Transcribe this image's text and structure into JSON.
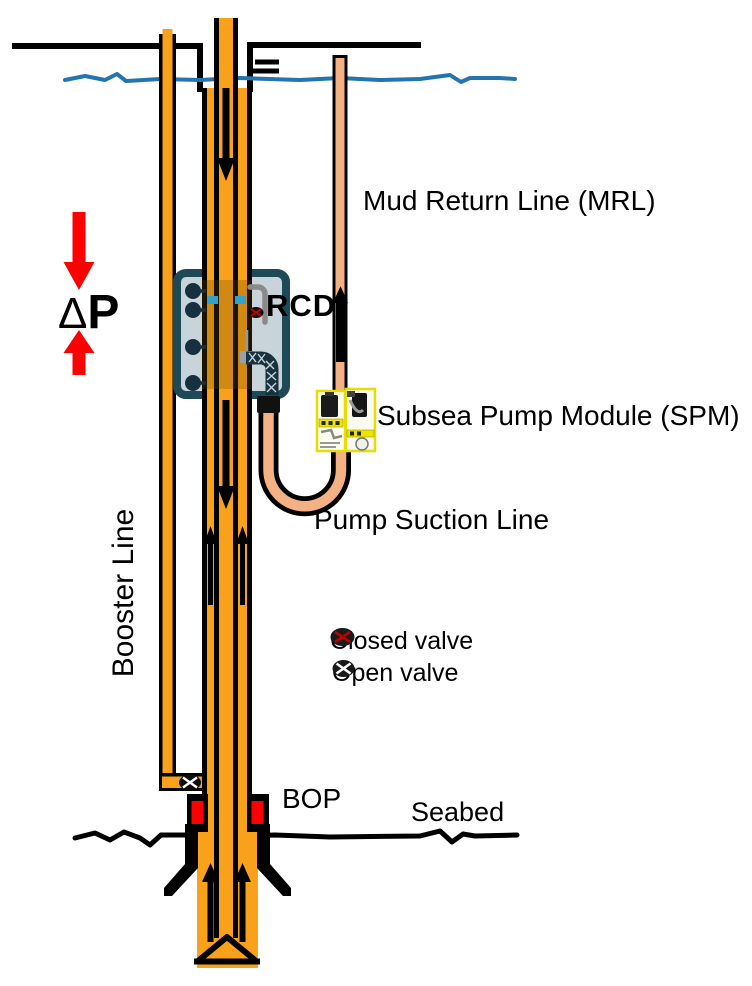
{
  "diagram": {
    "labels": {
      "mud_return_line": "Mud Return Line (MRL)",
      "rcd": "RCD",
      "subsea_pump_module": "Subsea Pump Module (SPM)",
      "pump_suction_line": "Pump Suction Line",
      "booster_line": "Booster Line",
      "bop": "BOP",
      "seabed": "Seabed",
      "delta": "Δ",
      "pressure": "P"
    },
    "legend": {
      "closed_valve_label": "Closed valve",
      "open_valve_label": "Open valve"
    },
    "icons": {
      "closed_valve": "black-ellipse-red-x",
      "open_valve": "black-ellipse-white-x",
      "flow_arrows": "black-directional-arrows",
      "pressure_arrows": "red-opposing-arrows"
    },
    "colors": {
      "pipe_orange": "#F9A11B",
      "return_line_light_orange": "#F4B183",
      "water_blue": "#2474AE",
      "bop_ram_red": "#FF0000",
      "pressure_arrow_red": "#FF0000",
      "rcd_housing_teal": "#1E4A57",
      "rcd_fill_gray": "#C9D3DA",
      "rcd_seal_cyan": "#2FA3CF",
      "valve_closed_x_red": "#C00000",
      "spm_panel_yellow": "#EDE402"
    }
  }
}
